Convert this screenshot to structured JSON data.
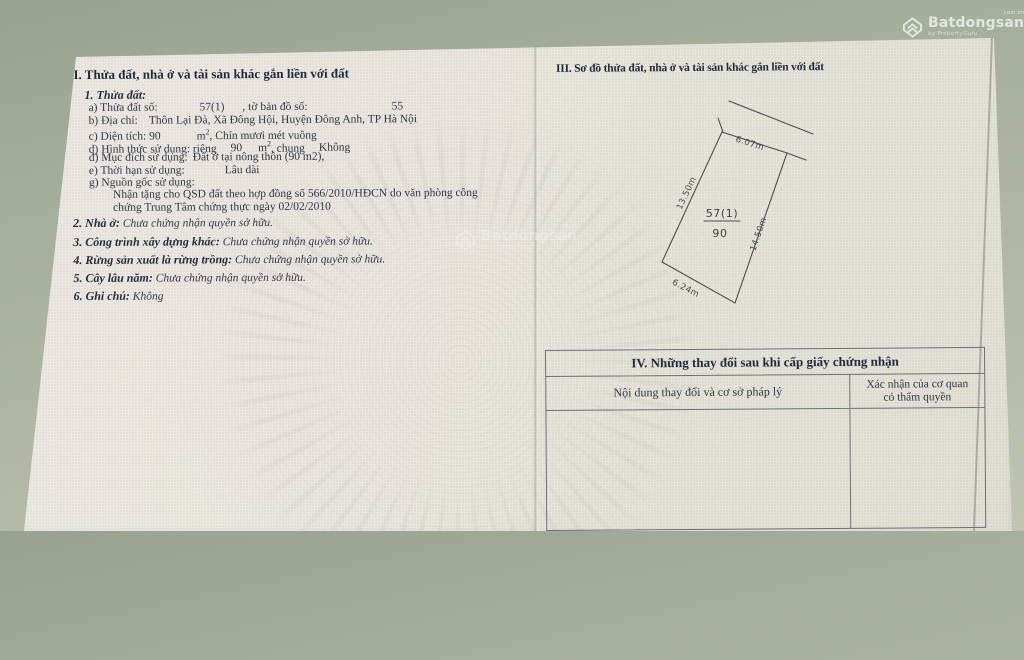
{
  "colors": {
    "background": "#a5ad9c",
    "paper": "#e9e6de",
    "ink": "#2d3848",
    "heading_ink": "#1e2b3c",
    "plot_line": "#4a4d50",
    "watermark": "#f2f5ee"
  },
  "watermark": {
    "brand": "Batdongsan",
    "domain": ".com.vn",
    "byline": "by PropertyGuru"
  },
  "section2": {
    "heading": "II. Thửa đất, nhà ở và tài sản khác gắn liền với đất",
    "sub1": "1. Thửa đất:",
    "a_label": "a) Thửa đất số:",
    "a_value": "57(1)",
    "a_label2": ", tờ bản đồ số:",
    "a_value2": "55",
    "b_label": "b) Địa chỉ:",
    "b_value": "Thôn Lại Đà, Xã Đông Hội, Huyện Đông Anh, TP Hà Nội",
    "c_label": "c) Diện tích: 90",
    "c_unit": "m",
    "c_unit_sup": "2",
    "c_text": ", Chín mươi mét vuông",
    "d_label": "d) Hình thức sử dụng: riêng",
    "d_value": "90",
    "d_unit": "m",
    "d_unit_sup": "2",
    "d_text": ", chung",
    "d_value2": "Không",
    "dd_label": "đ) Mục đích sử dụng:",
    "dd_value": "Đất ở tại nông thôn (90 m2),",
    "e_label": "e) Thời hạn sử dụng:",
    "e_value": "Lâu dài",
    "g_label": "g) Nguồn gốc sử dụng:",
    "g_line1": "Nhận tặng cho QSD đất theo hợp đồng số 566/2010/HĐCN do văn phòng công",
    "g_line2": "chứng Trung Tâm chứng thực ngày 02/02/2010",
    "n2_label": "2. Nhà ở:",
    "n2_value": "Chưa chứng nhận quyền sở hữu.",
    "n3_label": "3. Công trình xây dựng khác:",
    "n3_value": "Chưa chứng nhận quyền sở hữu.",
    "n4_label": "4. Rừng sản xuất là rừng trồng:",
    "n4_value": "Chưa chứng nhận quyền sở hữu.",
    "n5_label": "5. Cây lâu năm:",
    "n5_value": "Chưa chứng nhận quyền sở hữu.",
    "n6_label": "6. Ghi chú:",
    "n6_value": "Không"
  },
  "section3": {
    "heading": "III. Sơ đồ thửa đất, nhà ở và tài sản khác gắn liền với đất",
    "plot": {
      "parcel": "57(1)",
      "area": "90",
      "edge_top": "6.07m",
      "edge_left": "13.50m",
      "edge_right": "14.50m",
      "edge_bottom": "6.24m"
    }
  },
  "section4": {
    "title": "IV. Những thay đổi sau khi cấp giấy chứng nhận",
    "col1": "Nội dung thay đổi và cơ sở pháp lý",
    "col2_line1": "Xác nhận của cơ quan",
    "col2_line2": "có thẩm quyền"
  }
}
